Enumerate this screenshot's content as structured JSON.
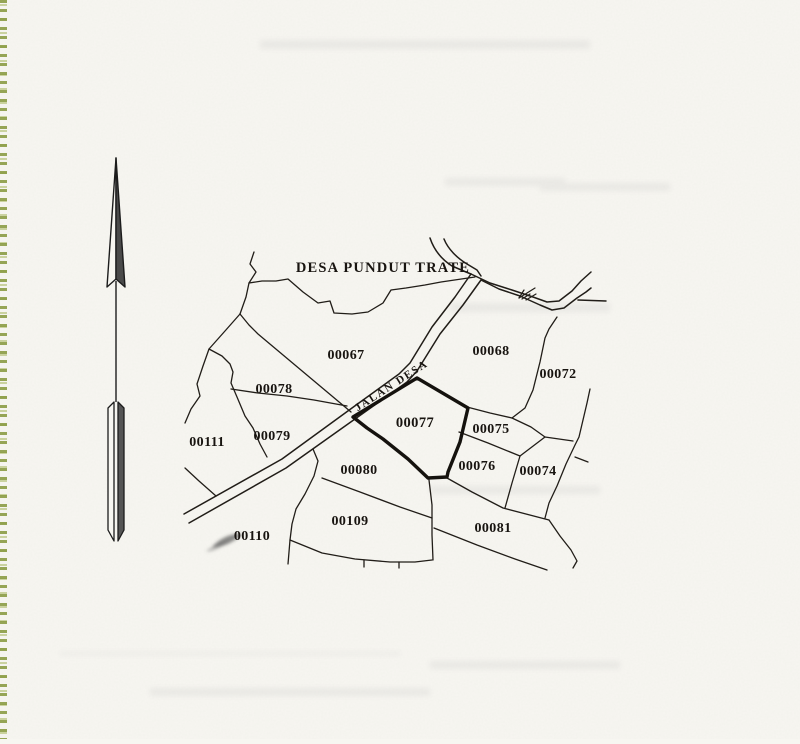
{
  "map": {
    "title": "DESA PUNDUT TRATE",
    "road_label": "JALAN DESA",
    "parcels": [
      {
        "label": "00067"
      },
      {
        "label": "00068"
      },
      {
        "label": "00072"
      },
      {
        "label": "00078"
      },
      {
        "label": "00079"
      },
      {
        "label": "00111"
      },
      {
        "label": "00077",
        "highlighted": true
      },
      {
        "label": "00075"
      },
      {
        "label": "00080"
      },
      {
        "label": "00076"
      },
      {
        "label": "00074"
      },
      {
        "label": "00110"
      },
      {
        "label": "00109"
      },
      {
        "label": "00081"
      }
    ],
    "icons": {
      "north_arrow": "north-arrow-icon",
      "road_hatch": "road-hatch-icon"
    }
  },
  "colors": {
    "paper": "#f7f6f1",
    "ink": "#211d18",
    "highlight_outline": "#15120e",
    "edge_marks": "#8b9c44",
    "arrow_fill": "#4a4a4a"
  }
}
